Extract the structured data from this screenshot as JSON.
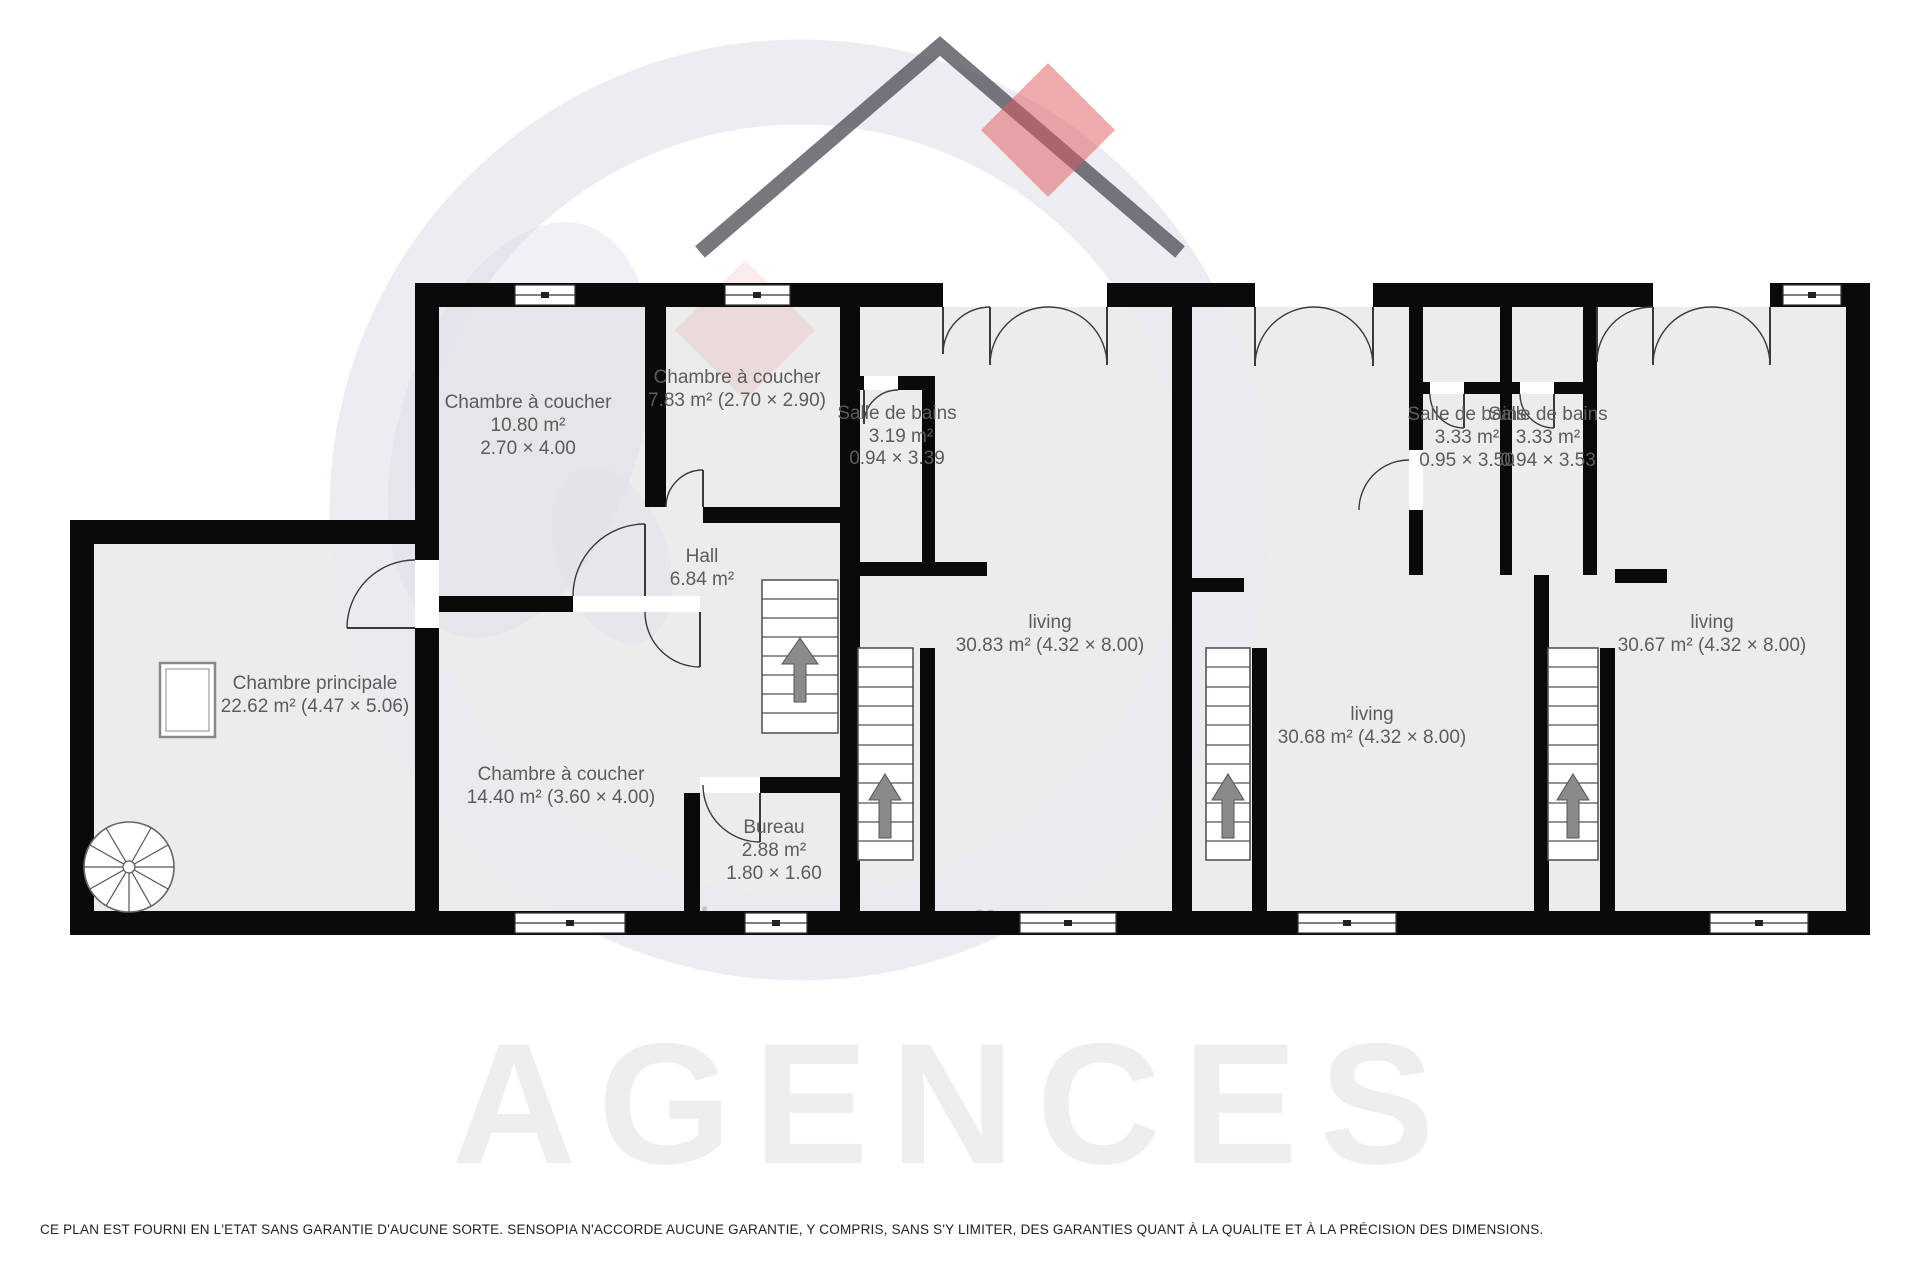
{
  "watermark": {
    "brand_text": "AGENCES",
    "logo_letter_m": "M",
    "logo_letters_os": "os",
    "ring_color": "#e9ebef",
    "house_color": "#51525a",
    "accent_red": "#e2575d",
    "letters_pink": "#e8b7c1"
  },
  "disclaimer": "CE PLAN EST FOURNI EN L'ETAT SANS GARANTIE D'AUCUNE SORTE. SENSOPIA N'ACCORDE AUCUNE GARANTIE, Y COMPRIS, SANS S'Y LIMITER, DES GARANTIES QUANT À LA QUALITE ET À LA PRÉCISION DES DIMENSIONS.",
  "colors": {
    "wall": "#0a0a0a",
    "room_fill": "#ececec",
    "label_text": "#5c5c5c"
  },
  "rooms": [
    {
      "id": "chambre-principale",
      "name": "Chambre principale",
      "dims": "22.62 m² (4.47 × 5.06)"
    },
    {
      "id": "chambre-a-coucher-1",
      "name": "Chambre à coucher",
      "area": "10.80 m²",
      "dims": "2.70 × 4.00"
    },
    {
      "id": "chambre-a-coucher-2",
      "name": "Chambre à coucher",
      "dims": "7.83 m² (2.70 × 2.90)"
    },
    {
      "id": "salle-de-bains-1",
      "name": "Salle de bains",
      "area": "3.19 m²",
      "dims": "0.94 × 3.39"
    },
    {
      "id": "hall",
      "name": "Hall",
      "area": "6.84 m²"
    },
    {
      "id": "chambre-a-coucher-3",
      "name": "Chambre à coucher",
      "dims": "14.40 m² (3.60 × 4.00)"
    },
    {
      "id": "bureau",
      "name": "Bureau",
      "area": "2.88 m²",
      "dims": "1.80 × 1.60"
    },
    {
      "id": "living-1",
      "name": "living",
      "dims": "30.83 m² (4.32 × 8.00)"
    },
    {
      "id": "salle-de-bains-2",
      "name": "Salle de bains",
      "area": "3.33 m²",
      "dims": "0.95 × 3.50"
    },
    {
      "id": "salle-de-bains-3",
      "name": "Salle de bains",
      "area": "3.33 m²",
      "dims": "0.94 × 3.53"
    },
    {
      "id": "living-2",
      "name": "living",
      "dims": "30.68 m² (4.32 × 8.00)"
    },
    {
      "id": "living-3",
      "name": "living",
      "dims": "30.67 m² (4.32 × 8.00)"
    }
  ]
}
